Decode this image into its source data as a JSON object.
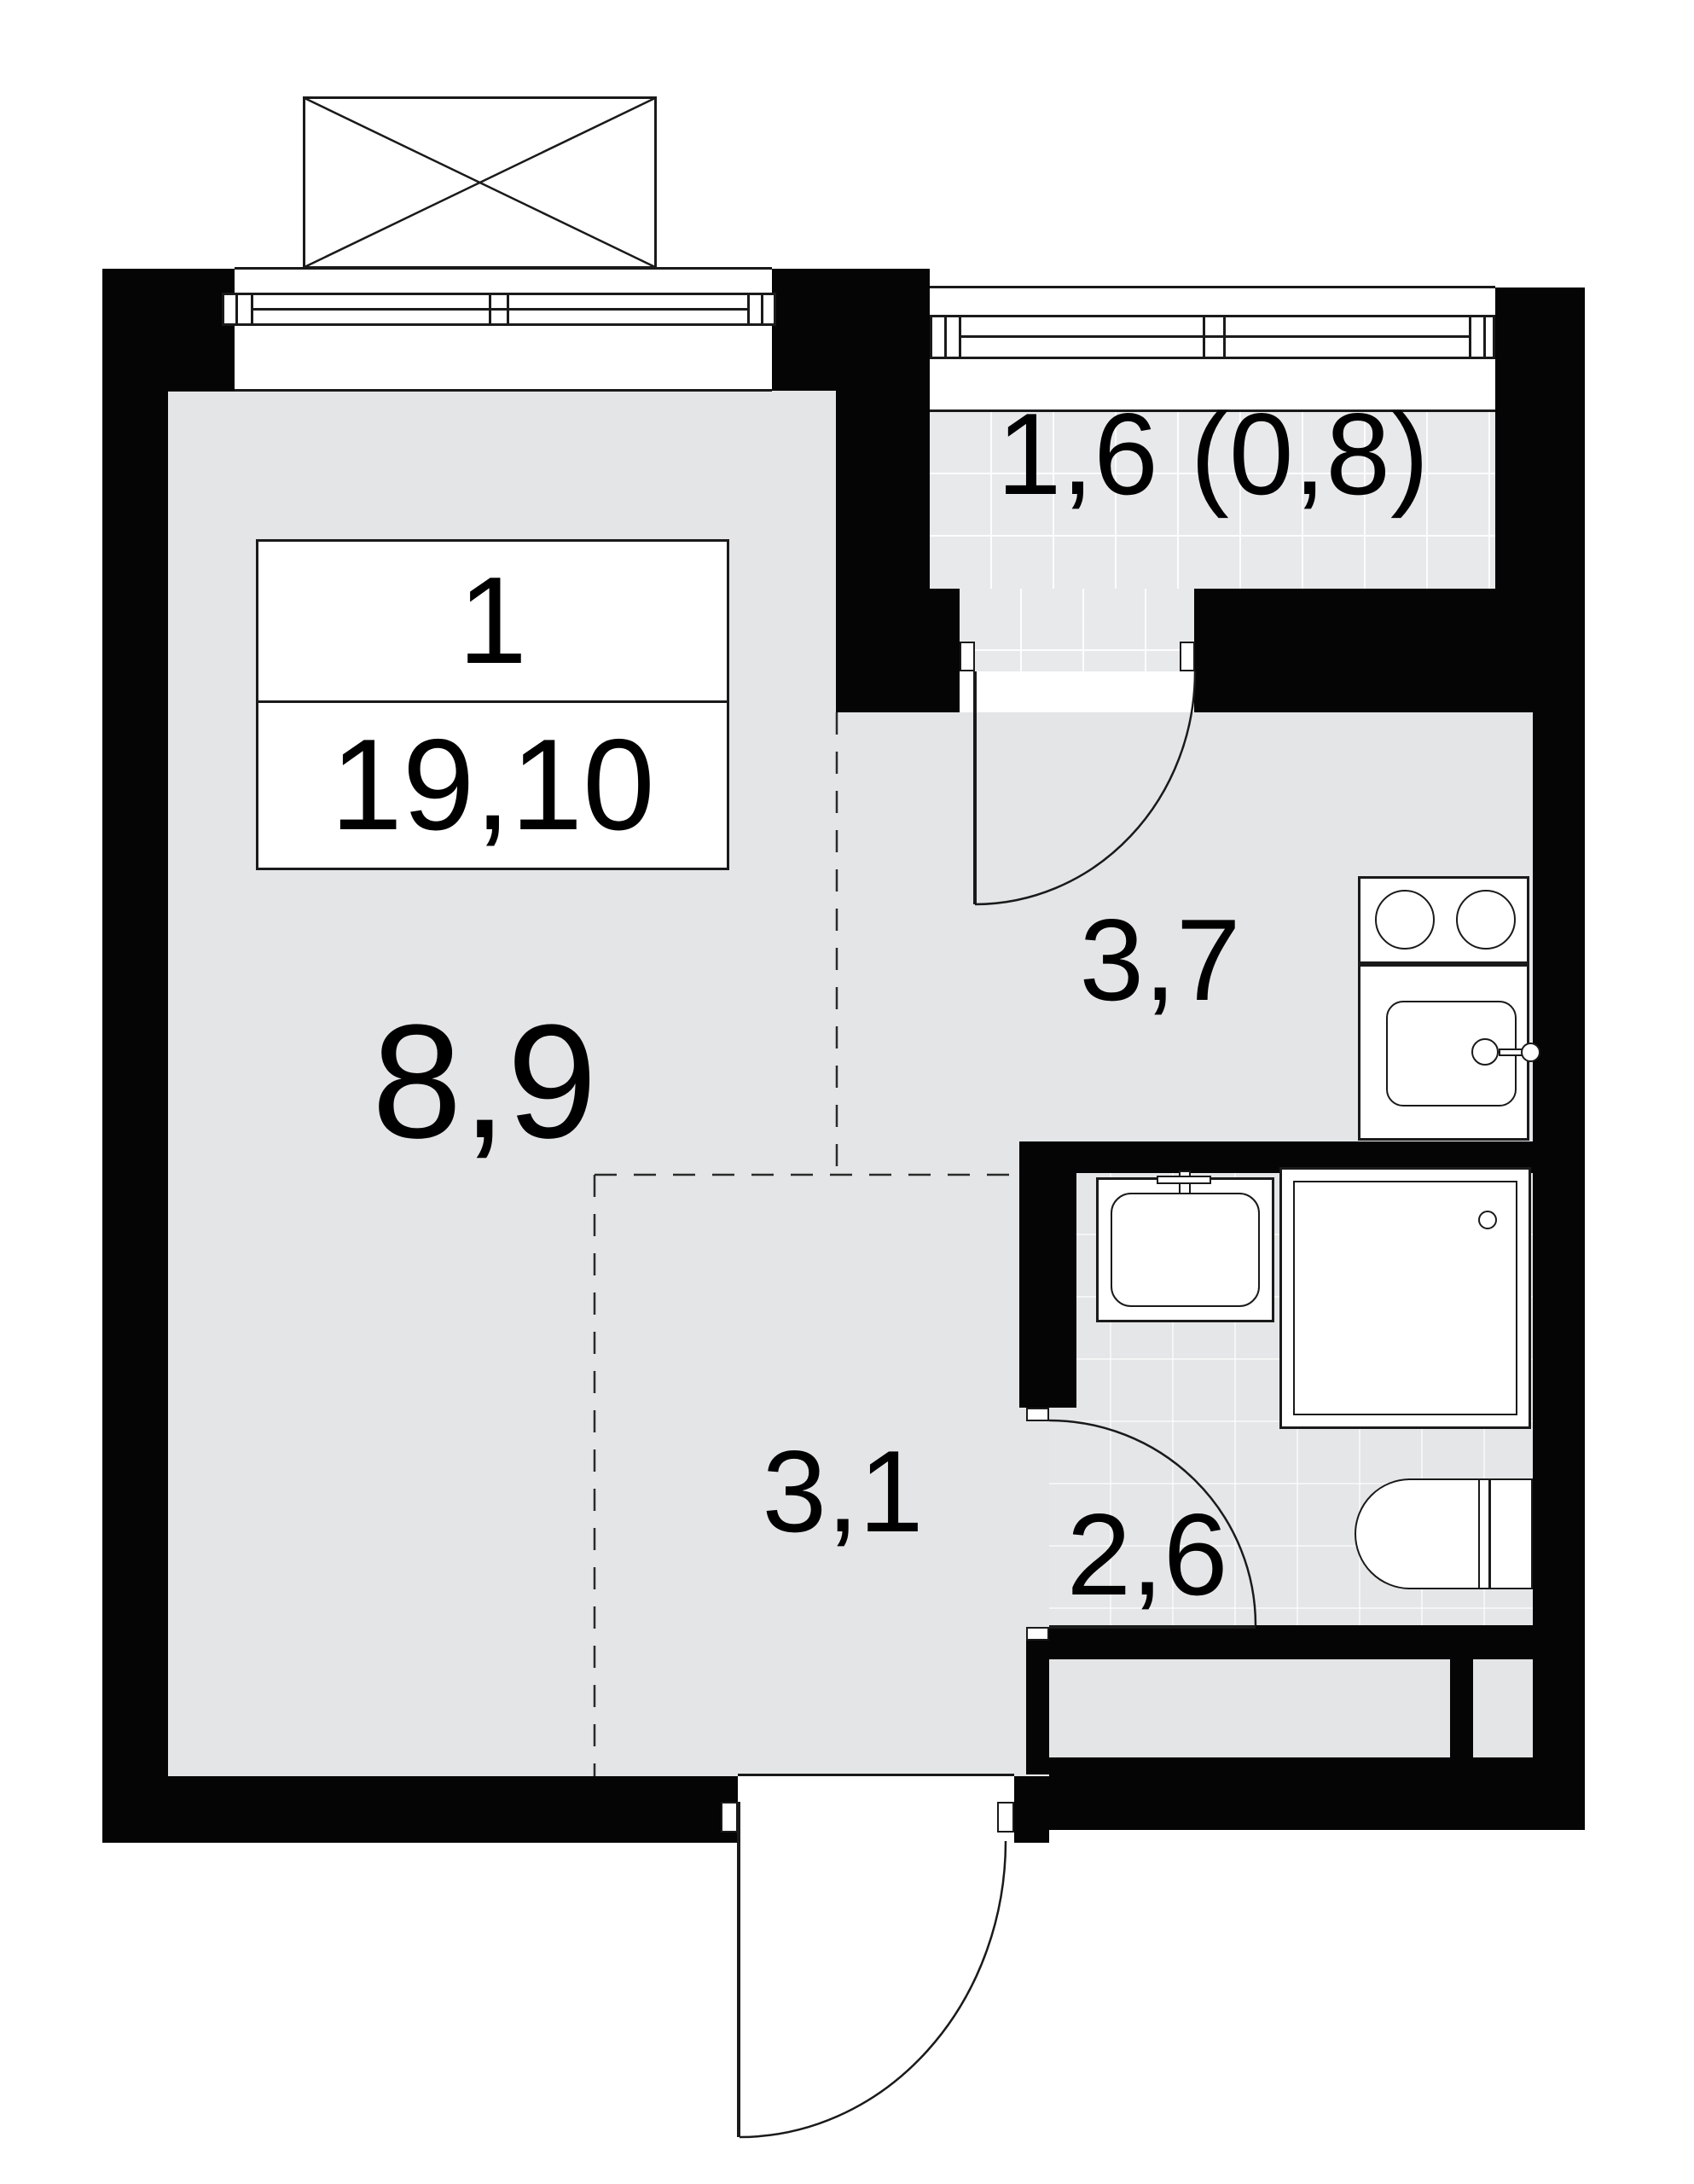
{
  "unit_card": {
    "rooms_count": "1",
    "total_area": "19,10"
  },
  "area_labels": {
    "living": "8,9",
    "kitchen": "3,7",
    "hall": "3,1",
    "bathroom": "2,6",
    "balcony": "1,6 (0,8)"
  },
  "colors": {
    "bg": "#ffffff",
    "wall": "#050505",
    "line": "#1a1a1a",
    "floor": "#e3e5e6",
    "tile": "#e7e9ea"
  }
}
